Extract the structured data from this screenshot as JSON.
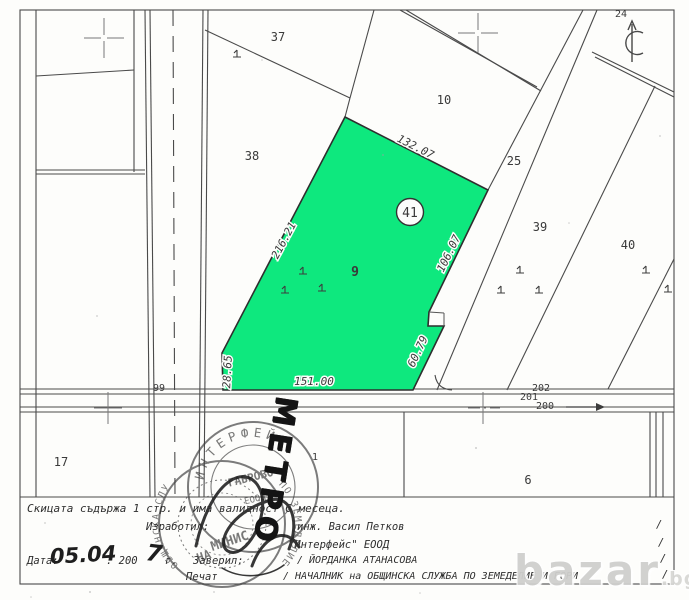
{
  "map": {
    "highlight_fill": "#0ee87e",
    "parcels": [
      {
        "id": "37"
      },
      {
        "id": "38"
      },
      {
        "id": "10"
      },
      {
        "id": "24"
      },
      {
        "id": "25"
      },
      {
        "id": "39"
      },
      {
        "id": "40"
      },
      {
        "id": "17"
      },
      {
        "id": "1"
      },
      {
        "id": "6"
      },
      {
        "id": "99"
      },
      {
        "id": "202"
      },
      {
        "id": "201"
      },
      {
        "id": "200"
      }
    ],
    "highlight": {
      "number": "41",
      "class_label": "9"
    },
    "dimensions": [
      {
        "t": "132.07"
      },
      {
        "t": "216.21"
      },
      {
        "t": "106.07"
      },
      {
        "t": "60.79"
      },
      {
        "t": "151.00"
      },
      {
        "t": "28.65"
      }
    ]
  },
  "footer": {
    "line1": "Скицата съдържа 1 стр. и има валидност 6 месеца.",
    "made_by_label": "Изработил:",
    "made_by": "инж. Васил Петков",
    "company": "\"Интерфейс\" ЕООД",
    "date_label": "Дата:",
    "date_handwritten": "05.04",
    "date_print": ". 200",
    "date_year_handwritten": "7",
    "date_suffix": "г.",
    "certified_label": "Заверил:",
    "certified_by": "/ ЙОРДАНКА АТАНАСОВА",
    "stamp_label": "Печат",
    "position_line": "/ НАЧАЛНИК на ОБЩИНСКА СЛУЖБА ПО ЗЕМЕДЕЛИЕ И ГОРИ",
    "slash": "/"
  },
  "stamps": {
    "company_arc": "ИНТЕРФЕЙС",
    "company_city": "ГАБРОВО",
    "company_type": "ЕООД",
    "ministry_arc_left": "ОБЩИНСКА СЛУЖБА",
    "ministry_arc_right": "ПО ЗЕМЕДЕЛИЕ",
    "ministry_center1": "МИНИС",
    "ministry_center2": "НА",
    "handwritten_overlay": "МЕТРО"
  },
  "watermark": {
    "text": "bazar",
    "tld": ".bg"
  }
}
